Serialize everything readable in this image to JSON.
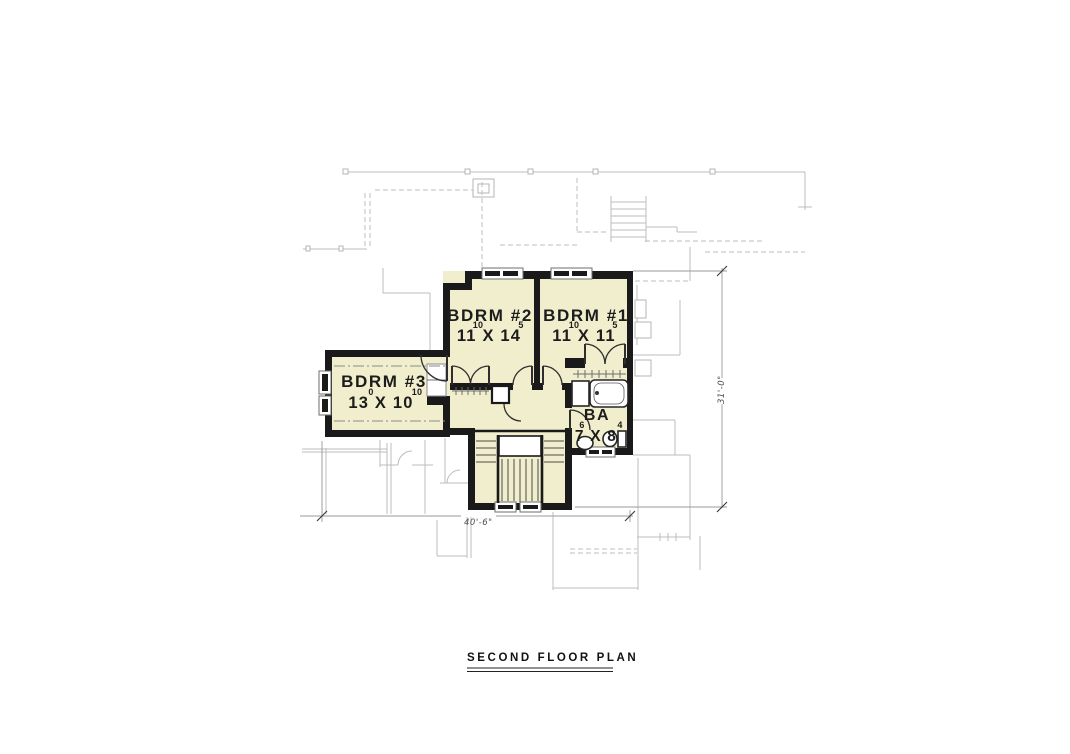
{
  "title": "SECOND FLOOR PLAN",
  "rooms": {
    "bdrm2": {
      "label": "BDRM #2",
      "dims": "11 X 14",
      "sup1": "10",
      "sup2": "5"
    },
    "bdrm1": {
      "label": "BDRM #1",
      "dims": "11 X 11",
      "sup1": "10",
      "sup2": "5"
    },
    "bdrm3": {
      "label": "BDRM #3",
      "dims": "13 X 10",
      "sup1": "0",
      "sup2": "10"
    },
    "bath": {
      "label": "BA",
      "dims": "7 X 8",
      "sup1": "6",
      "sup2": "4"
    }
  },
  "dimensions": {
    "overall_width": "40'-6\"",
    "overall_height": "31'-0\""
  },
  "colors": {
    "floor_fill": "#f1eecd",
    "wall": "#1a1a1a",
    "background_lines": "#bcbcbc",
    "dimension_lines": "#9a9a9a"
  }
}
